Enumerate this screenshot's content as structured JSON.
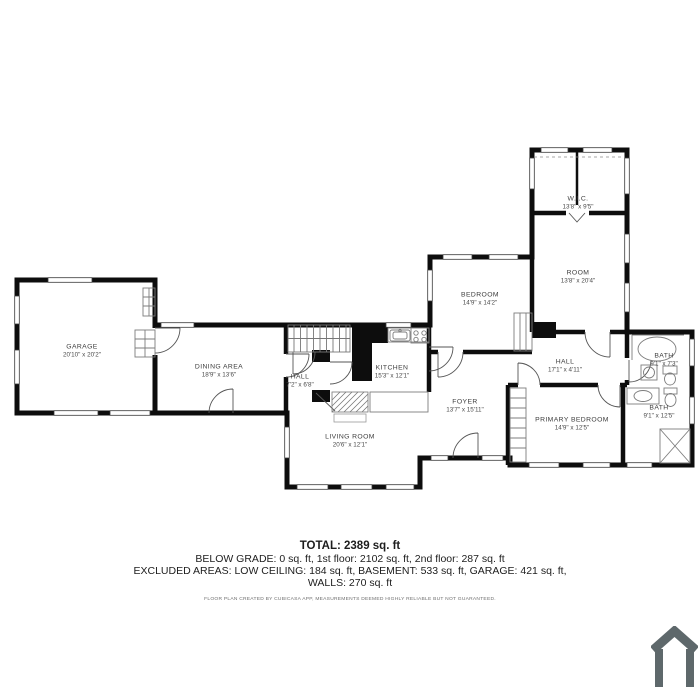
{
  "plan": {
    "rooms": [
      {
        "name": "GARAGE",
        "dims": "20'10\" x 20'2\""
      },
      {
        "name": "DINING AREA",
        "dims": "18'9\" x 13'6\""
      },
      {
        "name": "HALL",
        "dims": "7'2\" x 6'8\""
      },
      {
        "name": "KITCHEN",
        "dims": "15'3\" x 12'1\""
      },
      {
        "name": "LIVING ROOM",
        "dims": "20'6\" x 12'1\""
      },
      {
        "name": "FOYER",
        "dims": "13'7\" x 15'11\""
      },
      {
        "name": "BEDROOM",
        "dims": "14'9\" x 14'2\""
      },
      {
        "name": "ROOM",
        "dims": "13'8\" x 20'4\""
      },
      {
        "name": "W.I.C.",
        "dims": "13'8\" x 9'5\""
      },
      {
        "name": "HALL",
        "dims": "17'1\" x 4'11\""
      },
      {
        "name": "BATH",
        "dims": "9'1\" x 7'3\""
      },
      {
        "name": "BATH",
        "dims": "9'1\" x 12'5\""
      },
      {
        "name": "PRIMARY BEDROOM",
        "dims": "14'9\" x 12'5\""
      }
    ]
  },
  "summary": {
    "total": "TOTAL: 2389 sq. ft",
    "line1": "BELOW GRADE: 0 sq. ft, 1st floor: 2102 sq. ft, 2nd floor: 287 sq. ft",
    "line2": "EXCLUDED AREAS: LOW CEILING: 184 sq. ft, BASEMENT: 533 sq. ft, GARAGE: 421 sq. ft,",
    "line3": "WALLS: 270 sq. ft",
    "disclaimer": "FLOOR PLAN CREATED BY CUBICASA APP, MEASUREMENTS DEEMED HIGHLY RELIABLE BUT NOT GUARANTEED."
  },
  "branding": {
    "logo": "cubicasa-house-logo",
    "logo_color": "#5e686b"
  },
  "colors": {
    "wall": "#0d0d0d",
    "fixture": "#7d7d7d",
    "door": "#555555",
    "label": "#3d3d3d"
  }
}
